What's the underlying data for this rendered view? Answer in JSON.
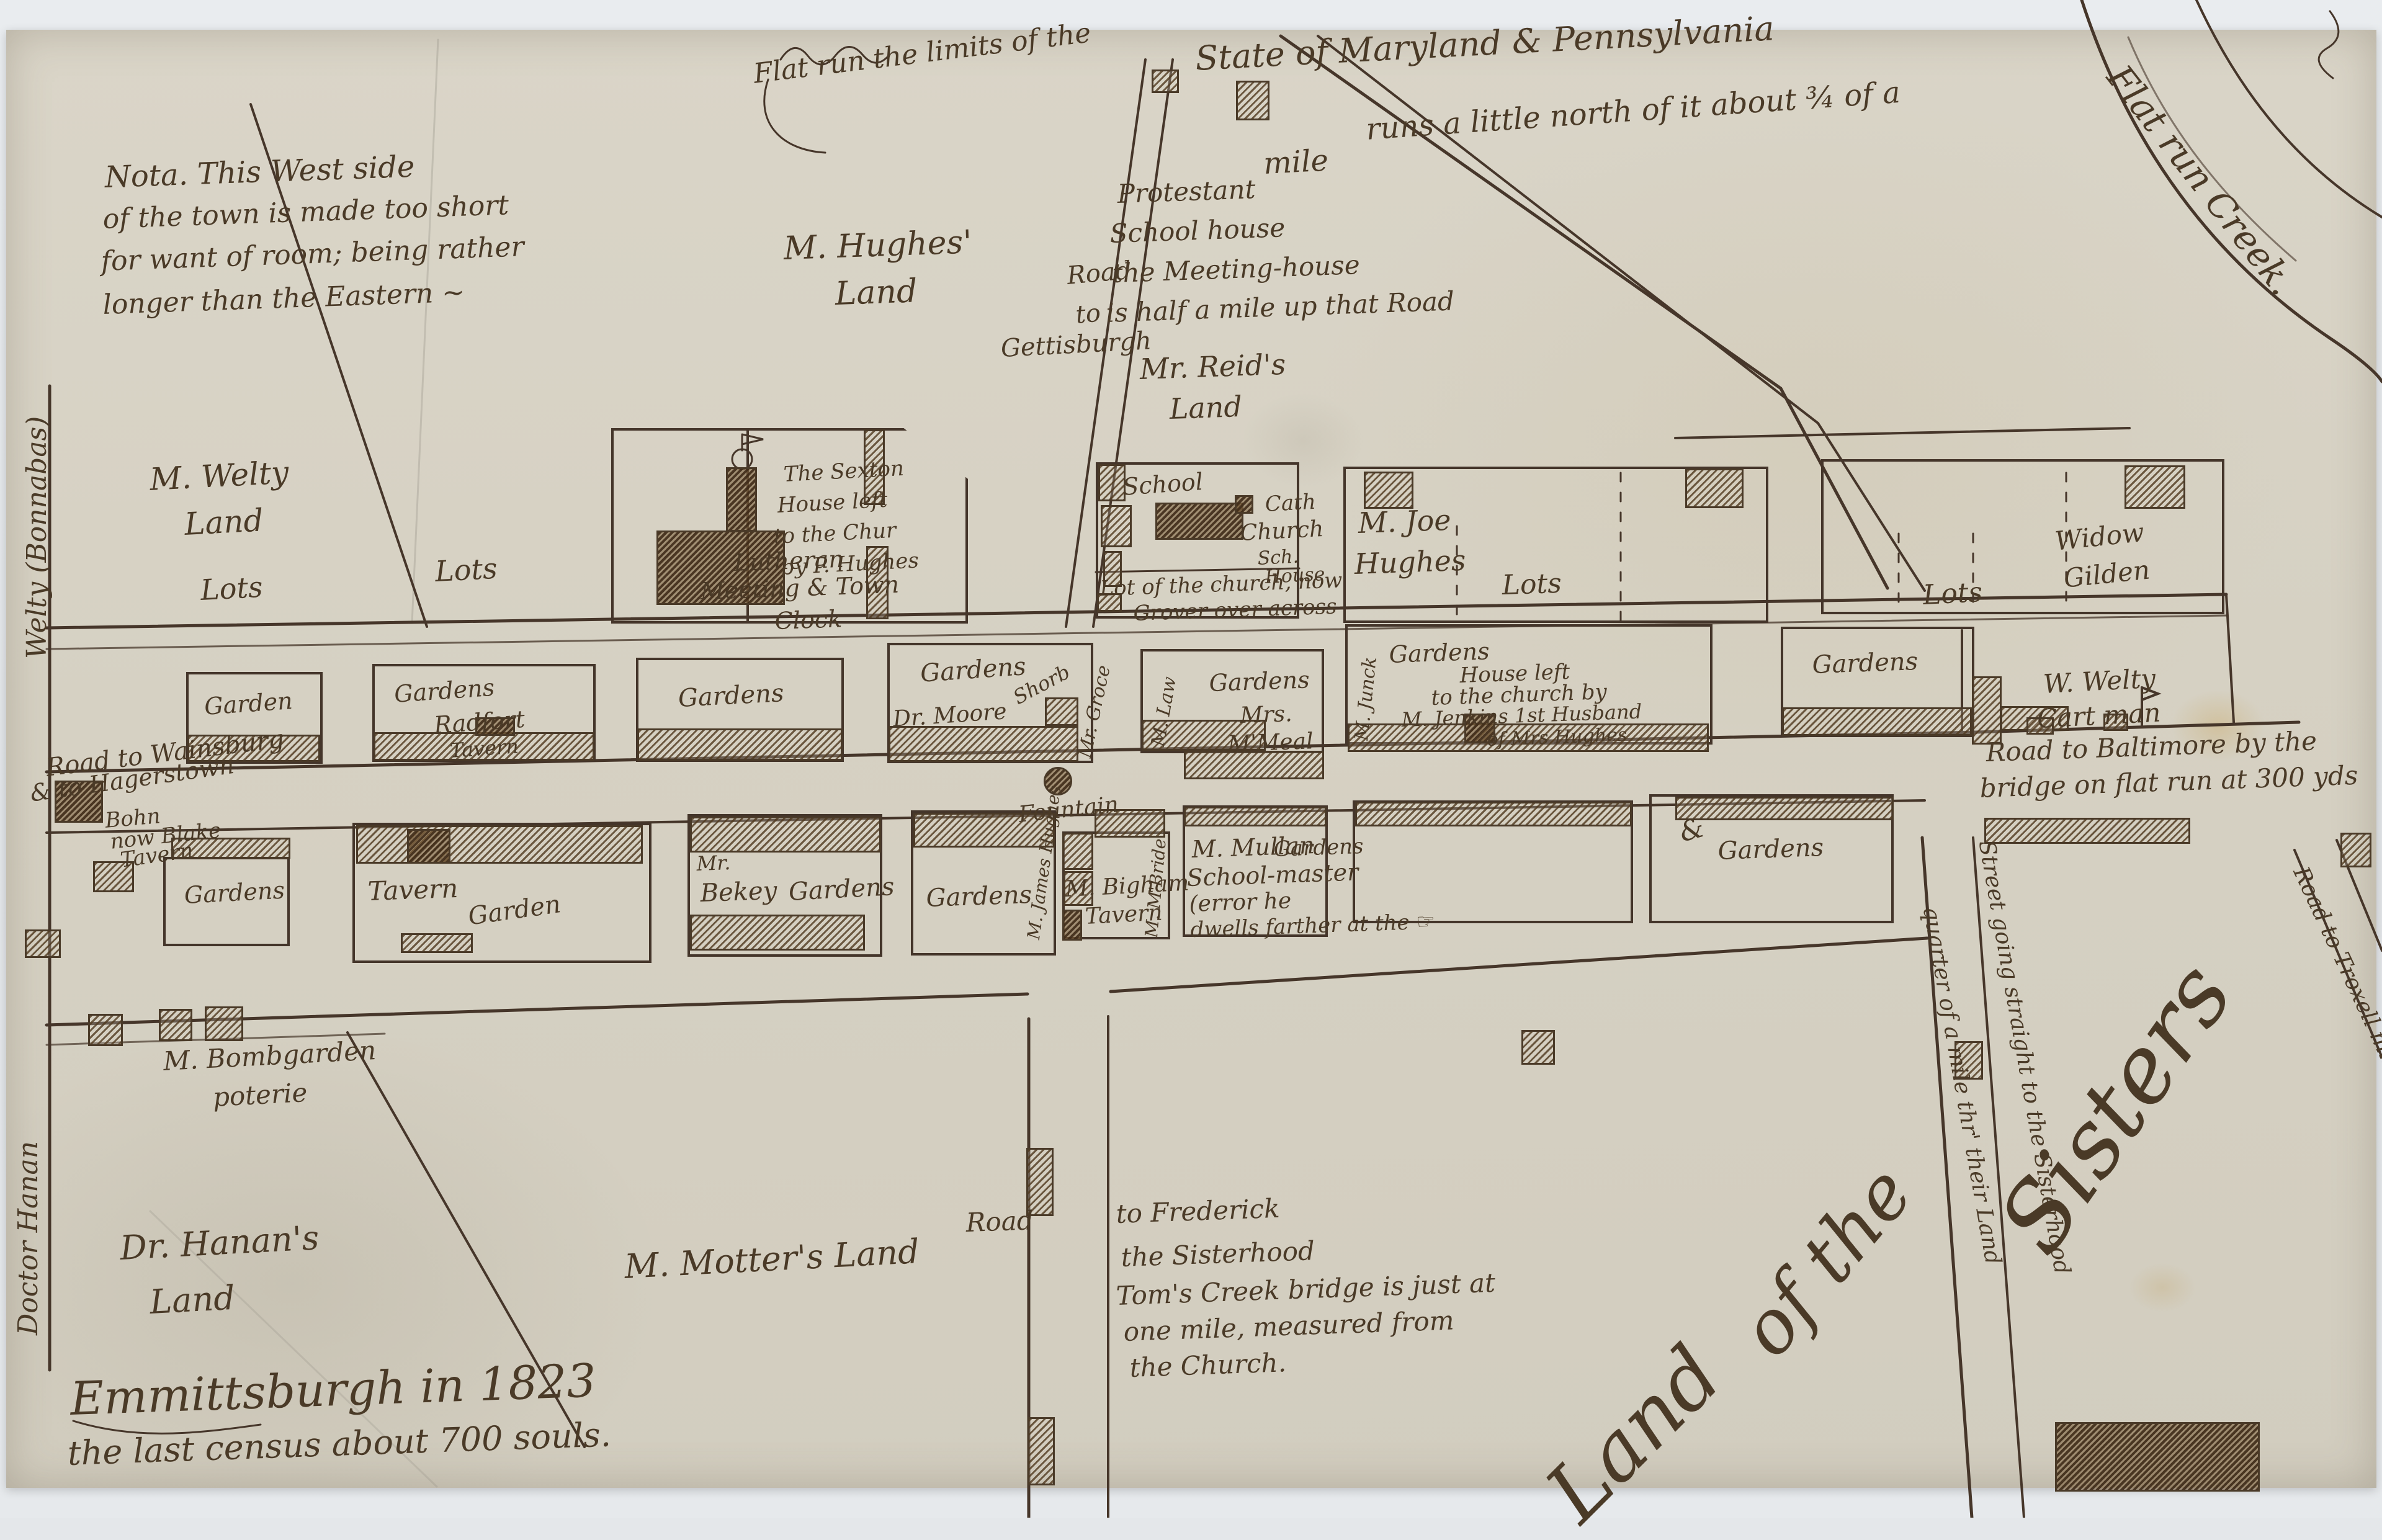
{
  "colors": {
    "paper": "#d6d1c3",
    "ink": "#4a3a27",
    "hatch_brown": "#5c4228",
    "photo_background": "#e6e9ec"
  },
  "notes": {
    "west_side_1": "Nota. This West side",
    "west_side_2": "of the town is made too short",
    "west_side_3": "for want of room; being rather",
    "west_side_4": "longer than the Eastern ~",
    "flat_run_limits": "Flat run  the limits of the",
    "state_line_1": "State of Maryland & Pennsylvania",
    "state_line_2": "runs a little north of it about ¾ of a",
    "state_line_3": "mile",
    "protestant_1": "Protestant",
    "protestant_2": "School house",
    "protestant_3": "the Meeting-house",
    "protestant_4": "is half a mile up that Road",
    "caption_1": "Emmittsburgh in 1823",
    "caption_2": "the last census about 700 souls."
  },
  "roads": {
    "gettysburgh_1": "Road",
    "gettysburgh_2": "to",
    "gettysburgh_3": "Gettisburgh",
    "baltimore_1": "Road to Baltimore by the",
    "baltimore_2": "bridge on flat run at 300 yds",
    "wainsburg_1": "Road to Wainsburg",
    "wainsburg_2": "& to Hagerstown",
    "wainsburg_3": "Bohn",
    "wainsburg_4": "now Blake",
    "wainsburg_5": "Tavern",
    "frederick_1": "Road",
    "frederick_2": "to Frederick",
    "frederick_3": "the Sisterhood",
    "frederick_4": "Tom's Creek bridge is just at",
    "frederick_5": "one mile, measured from",
    "frederick_6": "the Church.",
    "sisterhood_1": "Street going straight to the Sisterhood",
    "sisterhood_2": "quarter of a mile thr' their Land",
    "troxell": "Road to Troxell mill",
    "creek": "Flat run Creek."
  },
  "lands": {
    "hughes_1": "M. Hughes'",
    "hughes_2": "Land",
    "reid_1": "Mr. Reid's",
    "reid_2": "Land",
    "welty_edge": "Welty (Bonnabas)",
    "welty_1": "M. Welty",
    "welty_2": "Land",
    "welty_lots": "Lots",
    "lots_east": "Lots",
    "w_welty_1": "W. Welty",
    "w_welty_2": "Cart man",
    "hanan_edge": "Doctor Hanan",
    "hanan_1": "Dr. Hanan's",
    "hanan_2": "Land",
    "motter": "M. Motter's Land",
    "sisters_1": "Land",
    "sisters_2": "of the",
    "sisters_3": "Sisters",
    "bombgarden_1": "M. Bombgarden",
    "bombgarden_2": "poterie"
  },
  "lots_row": {
    "lutheran_1": "Lutheran",
    "lutheran_2": "Meeting & Town",
    "lutheran_3": "Clock",
    "sexton_1": "The Sexton",
    "sexton_2": "House left",
    "sexton_3": "to the Chur",
    "sexton_4": "by P. Hughes",
    "school": "School",
    "cath_1": "Cath",
    "cath_2": "Church",
    "cath_3": "Sch.",
    "cath_4": "House",
    "church_lot_1": "Lot of the church, now",
    "church_lot_2": "Grover over across",
    "joe_hughes_1": "M. Joe",
    "joe_hughes_2": "Hughes",
    "joe_hughes_3": "Lots",
    "gilden_lots": "Lots",
    "gilden_1": "Widow",
    "gilden_2": "Gilden"
  },
  "row1": {
    "b1": "Garden",
    "b2_1": "Gardens",
    "b2_2": "Radfort",
    "b2_3": "Tavern",
    "b3": "Gardens",
    "b4_1": "Gardens",
    "b4_2": "Dr. Moore",
    "b4_3": "Shorb",
    "b4_side": "Mr. Groce",
    "b5_side": "M. Law",
    "b5_1": "Gardens",
    "b5_2": "Mrs.",
    "b5_3": "M'Meal",
    "b6_side": "M. Junck",
    "b6_1": "Gardens",
    "b6_2": "House left",
    "b6_3": "to the church by",
    "b6_4": "M. Jenkins 1st Husband",
    "b6_5": "of Mrs Hughes",
    "b7": "Gardens"
  },
  "row2": {
    "b1": "Gardens",
    "b2_1": "Tavern",
    "b2_2": "Garden",
    "b3_1": "Mr.",
    "b3_2": "Bekey",
    "b3_3": "Gardens",
    "b4": "Gardens",
    "b4_side": "M. James Hughes",
    "b5_1": "M. Bigham",
    "b5_2": "Tavern",
    "b5_side": "M. M'Bride",
    "b6_1": "M. Mullan",
    "b6_2": "School-master",
    "b6_3": "Gardens",
    "b6_4": "(error he",
    "b6_5": "dwells farther at the ☞",
    "b7": "Gardens",
    "b7_mark": "&"
  },
  "landmarks": {
    "fountain": "Fountain"
  }
}
